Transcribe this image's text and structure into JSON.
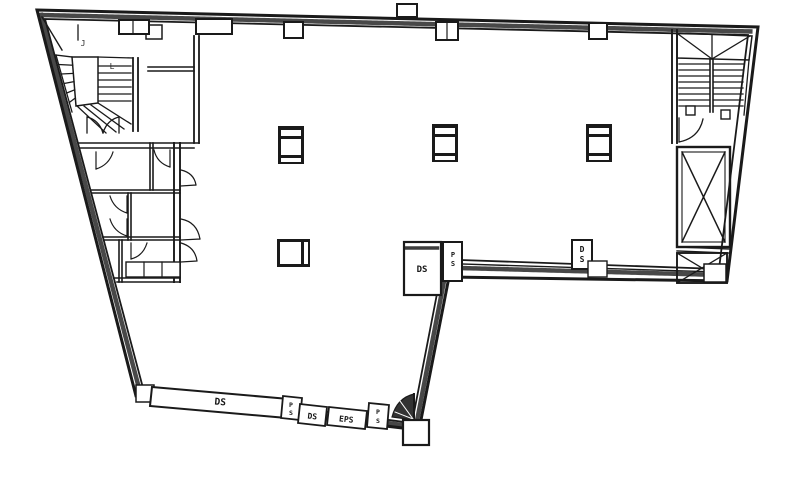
{
  "colors": {
    "background": "#ffffff",
    "ink": "#1a1a1a"
  },
  "shafts": {
    "ds_long": "DS",
    "ps_long_end": {
      "line1": "P",
      "line2": "S"
    },
    "ds_small": "DS",
    "eps": "EPS",
    "ps_corner": {
      "line1": "P",
      "line2": "S"
    },
    "ds_mid": "DS",
    "ps_mid": {
      "line1": "P",
      "line2": "S"
    },
    "ds_east": {
      "line1": "D",
      "line2": "S"
    }
  },
  "annotations": {
    "stair_mark_a": "J",
    "stair_mark_b": "L"
  }
}
